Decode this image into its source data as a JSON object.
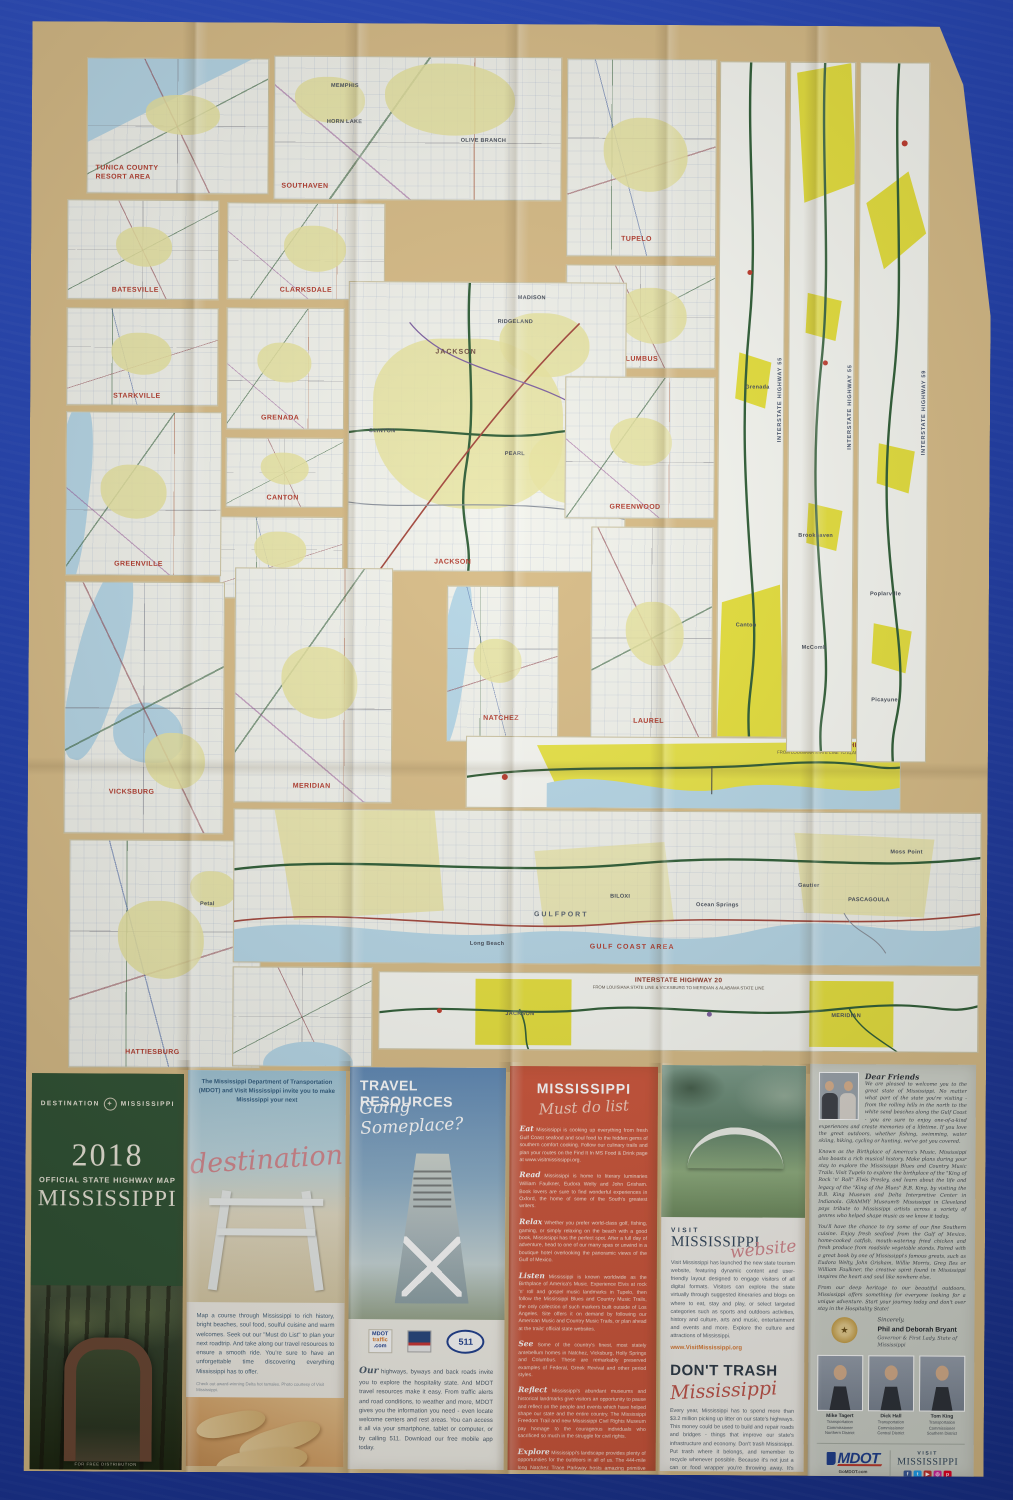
{
  "colors": {
    "background_blue": "#1e3dab",
    "sheet_tan": "#d8bc86",
    "inset_paper": "#f2f3ec",
    "urban_pale": "#e9e4a0",
    "urban_bright": "#e7e13b",
    "water": "#b6d7e7",
    "label_red": "#b23a2c",
    "panel_green": "#2e5132",
    "panel_red": "#cd5439"
  },
  "map": {
    "insets": [
      {
        "label": "TUNICA COUNTY RESORT AREA"
      },
      {
        "label": "SOUTHAVEN",
        "towns": [
          "MEMPHIS",
          "HORN LAKE",
          "OLIVE BRANCH"
        ]
      },
      {
        "label": "TUPELO"
      },
      {
        "label": "BATESVILLE"
      },
      {
        "label": "CLARKSDALE"
      },
      {
        "label": "COLUMBUS"
      },
      {
        "label": "STARKVILLE"
      },
      {
        "label": "GRENADA"
      },
      {
        "label": "CANTON"
      },
      {
        "label": "JACKSON",
        "towns": [
          "RIDGELAND",
          "MADISON",
          "CLINTON",
          "PEARL",
          "BRANDON"
        ]
      },
      {
        "label": "OXFORD"
      },
      {
        "label": "GREENVILLE"
      },
      {
        "label": "VICKSBURG"
      },
      {
        "label": "MERIDIAN"
      },
      {
        "label": "NATCHEZ"
      },
      {
        "label": "LAUREL"
      },
      {
        "label": "HATTIESBURG",
        "towns": [
          "Petal"
        ]
      },
      {
        "label": "GREENWOOD"
      },
      {
        "label": "GULF COAST AREA",
        "towns": [
          "GULFPORT",
          "BILOXI",
          "Ocean Springs",
          "Gautier",
          "PASCAGOULA",
          "Moss Point",
          "Long Beach"
        ]
      }
    ],
    "strips_vertical": [
      {
        "label": "INTERSTATE HIGHWAY 55",
        "towns": [
          "Grenada",
          "Canton"
        ]
      },
      {
        "label": "INTERSTATE HIGHWAY 55",
        "towns": [
          "Brookhaven",
          "McComb"
        ]
      },
      {
        "label": "INTERSTATE HIGHWAY 59",
        "towns": [
          "Poplarville",
          "Picayune"
        ]
      }
    ],
    "strip_i10": {
      "title": "INTERSTATE HIGHWAY 10",
      "subtitle": "FROM LOUISIANA STATE LINE TO ALABAMA STATE LINE"
    },
    "strip_i20": {
      "title": "INTERSTATE HIGHWAY 20",
      "subtitle": "FROM LOUISIANA STATE LINE & VICKSBURG TO MERIDIAN & ALABAMA STATE LINE",
      "towns": [
        "JACKSON",
        "MERIDIAN"
      ]
    }
  },
  "panels": {
    "cover": {
      "brand_left": "DESTINATION",
      "brand_right": "MISSISSIPPI",
      "compass": "✦",
      "year": "2018",
      "subtitle": "OFFICIAL STATE HIGHWAY MAP",
      "state": "MISSISSIPPI",
      "footnote": "FOR FREE DISTRIBUTION"
    },
    "destination": {
      "intro": "The Mississippi Department of Transportation (MDOT) and Visit Mississippi invite you to make Mississippi your next",
      "script": "destination",
      "body": "Map a course through Mississippi to rich history, bright beaches, soul food, soulful cuisine and warm welcomes. Seek out our \"Must do List\" to plan your next roadtrip. And take along our travel resources to ensure a smooth ride. You're sure to have an unforgettable time discovering everything Mississippi has to offer.",
      "caption": "Check out award-winning Delta hot tamales. Photo courtesy of Visit Mississippi."
    },
    "travel": {
      "title": "TRAVEL RESOURCES",
      "script": "Going Someplace?",
      "logo_mdottraffic_1": "MDOT",
      "logo_mdottraffic_2": "traffic",
      "logo_mdottraffic_3": ".com",
      "logo_511": "511",
      "body_lead": "Our",
      "body": "highways, byways and back roads invite you to explore the hospitality state. And MDOT travel resources make it easy. From traffic alerts and road conditions, to weather and more, MDOT gives you the information you need - even locate welcome centers and rest areas. You can access it all via your smartphone, tablet or computer, or by calling 511. Download our free mobile app today."
    },
    "must_do": {
      "title": "MISSISSIPPI",
      "script": "Must do list",
      "items": [
        {
          "lead": "Eat",
          "text": "Mississippi is cooking up everything from fresh Gulf Coast seafood and soul food to the hidden gems of southern comfort cooking. Follow our culinary trails and plan your routes on the Find It In MS Food & Drink page at www.visitmississippi.org."
        },
        {
          "lead": "Read",
          "text": "Mississippi is home to literary luminaries William Faulkner, Eudora Welty and John Grisham. Book lovers are sure to find wonderful experiences in Oxford, the home of some of the South's greatest writers."
        },
        {
          "lead": "Relax",
          "text": "Whether you prefer world-class golf, fishing, gaming, or simply relaxing on the beach with a good book, Mississippi has the perfect spot. After a full day of adventure, head to one of our many spas or unwind in a boutique hotel overlooking the panoramic views of the Gulf of Mexico."
        },
        {
          "lead": "Listen",
          "text": "Mississippi is known worldwide as the Birthplace of America's Music. Experience Elvis at rock 'n' roll and gospel music landmarks in Tupelo, then follow the Mississippi Blues and Country Music Trails, the only collection of such markers built outside of Los Angeles. Site offers it on demand by following our American Music and Country Music Trails, or plan ahead at the trails' official state websites."
        },
        {
          "lead": "See",
          "text": "Some of the country's finest, most stately antebellum homes in Natchez, Vicksburg, Holly Springs and Columbus. These are remarkably preserved examples of Federal, Greek Revival and other period styles."
        },
        {
          "lead": "Reflect",
          "text": "Mississippi's abundant museums and historical landmarks give visitors an opportunity to pause and reflect on the people and events which have helped shape our state and the entire country. The Mississippi Freedom Trail and new Mississippi Civil Rights Museum pay homage to the courageous individuals who sacrificed so much in the struggle for civil rights."
        },
        {
          "lead": "Explore",
          "text": "Mississippi's landscape provides plenty of opportunities for the outdoors in all of us. The 444-mile long Natchez Trace Parkway hosts amazing primitive hiking trails, while the scenic Gulf Coast spans miles of white sand beaches and 25,000 years of history. Whether you prefer to hike, bike or drive, visit one of our 25 state parks, with offerings such as hiking, camping, rock climbing and canoeing, www.mdwfp.com, and explore Mississippi's 1.2 million acres of national forests."
        }
      ]
    },
    "website": {
      "logo_top": "VISIT",
      "logo_main": "MISSISSIPPI",
      "script": "website",
      "body": "Visit Mississippi has launched the new state tourism website, featuring dynamic content and user-friendly layout designed to engage visitors of all digital formats. Visitors can explore the state virtually through suggested itineraries and blogs on where to eat, stay and play, or select targeted categories such as sports and outdoors activities, history and culture, arts and music, entertainment and events and more. Explore the culture and attractions of Mississippi.",
      "link": "www.VisitMississippi.org",
      "dont_trash_title": "DON'T TRASH",
      "dont_trash_script": "Mississippi",
      "dont_trash_body": "Every year, Mississippi has to spend more than $3.2 million picking up litter on our state's highways. This money could be used to build and repair roads and bridges - things that improve our state's infrastructure and economy. Don't trash Mississippi. Put trash where it belongs, and remember to recycle whenever possible. Because it's not just a can or food wrapper you're throwing away. It's Mississippi's money.",
      "dont_trash_link": "GoMDOT.com/DontTrashMS"
    },
    "letter": {
      "salutation": "Dear Friends",
      "p1": "We are pleased to welcome you to the great state of Mississippi. No matter what part of the state you're visiting - from the rolling hills in the north to the white sand beaches along the Gulf Coast - you are sure to enjoy one-of-a-kind experiences and create memories of a lifetime. If you love the great outdoors, whether fishing, swimming, water skiing, hiking, cycling or hunting, we've got you covered.",
      "p2": "Known as the Birthplace of America's Music, Mississippi also boasts a rich musical history. Make plans during your stay to explore the Mississippi Blues and Country Music Trails. Visit Tupelo to explore the birthplace of the \"King of Rock 'n' Roll\" Elvis Presley, and learn about the life and legacy of the \"King of the Blues\" B.B. King, by visiting the B.B. King Museum and Delta Interpretive Center in Indianola. GRAMMY Museum® Mississippi in Cleveland pays tribute to Mississippi artists across a variety of genres who helped shape music as we know it today.",
      "p3": "You'll have the chance to try some of our fine Southern cuisine. Enjoy fresh seafood from the Gulf of Mexico, home-cooked catfish, mouth-watering fried chicken and fresh produce from roadside vegetable stands. Paired with a great book by one of Mississippi's famous greats, such as Eudora Welty, John Grisham, Willie Morris, Greg Iles or William Faulkner, the creative spirit found in Mississippi inspires the heart and soul like nowhere else.",
      "p4": "From our deep heritage to our beautiful outdoors, Mississippi offers something for everyone looking for a unique adventure. Start your journey today and don't over stay in the Hospitality State!",
      "closing": "Sincerely,",
      "signers": "Phil and Deborah Bryant",
      "signers_title": "Governor & First Lady, State of Mississippi",
      "seal_glyph": "★",
      "commissioners": [
        {
          "name": "Mike Tagert",
          "title": "Transportation Commissioner",
          "district": "Northern District"
        },
        {
          "name": "Dick Hall",
          "title": "Transportation Commissioner",
          "district": "Central District"
        },
        {
          "name": "Tom King",
          "title": "Transportation Commissioner",
          "district": "Southern District"
        }
      ],
      "mdot_logo": "MDOT",
      "mdot_tag": "GoMDOT.com",
      "mdot_hashtag": "#MississippiDOT",
      "visit_logo_top": "VISIT",
      "visit_logo": "MISSISSIPPI",
      "visit_tag": "VisitMississippi.org",
      "visit_hashtag": "#VisitMississippi"
    }
  }
}
